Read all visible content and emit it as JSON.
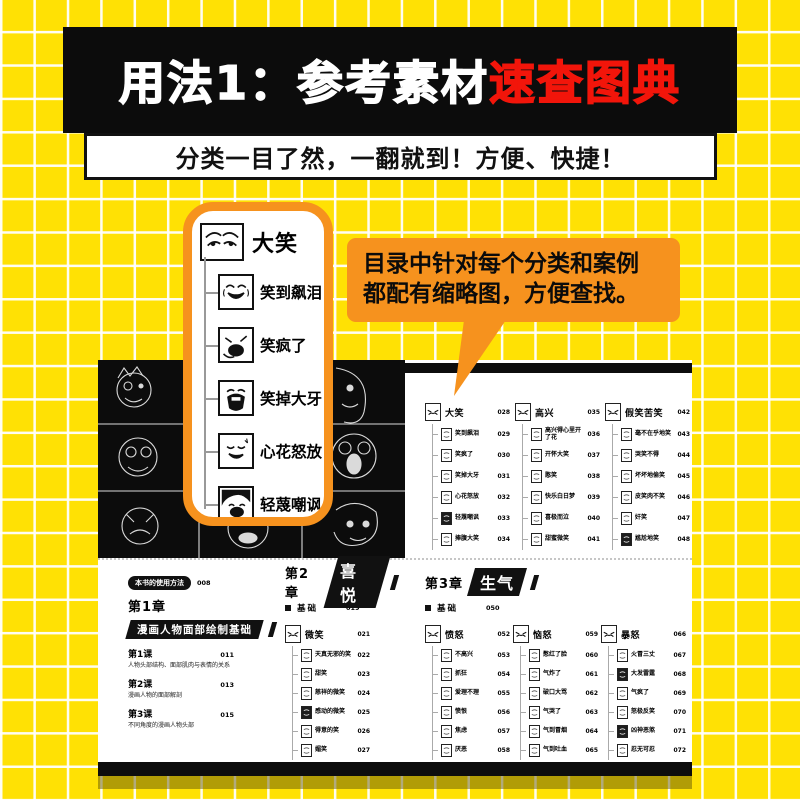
{
  "banner": {
    "title_white": "用法1：参考素材",
    "title_red": "速查图典"
  },
  "subtitle": {
    "text": "分类一目了然，一翻就到！方便、快捷！"
  },
  "bubble": {
    "line1": "目录中针对每个分类和案例",
    "line2": "都配有缩略图，方便查找。"
  },
  "callout": {
    "header_label": "大笑",
    "items": [
      {
        "label": "笑到飙泪",
        "icon": "laugh-tears-thumb"
      },
      {
        "label": "笑疯了",
        "icon": "laugh-crazy-thumb"
      },
      {
        "label": "笑掉大牙",
        "icon": "laugh-big-mouth-thumb"
      },
      {
        "label": "心花怒放",
        "icon": "laugh-bloom-thumb"
      },
      {
        "label": "轻蔑嘲讽",
        "icon": "sneer-face-thumb"
      }
    ]
  },
  "book": {
    "toc_top": {
      "columns": [
        {
          "title": "大笑",
          "page": "028",
          "items": [
            {
              "label": "笑到飙泪",
              "page": "029"
            },
            {
              "label": "笑疯了",
              "page": "030"
            },
            {
              "label": "笑掉大牙",
              "page": "031"
            },
            {
              "label": "心花怒放",
              "page": "032"
            },
            {
              "label": "轻蔑嘲讽",
              "page": "033",
              "dark": true
            },
            {
              "label": "捧腹大笑",
              "page": "034"
            }
          ]
        },
        {
          "title": "高兴",
          "page": "035",
          "items": [
            {
              "label": "高兴得心里开了花",
              "page": "036"
            },
            {
              "label": "开怀大笑",
              "page": "037"
            },
            {
              "label": "憨笑",
              "page": "038"
            },
            {
              "label": "快乐白日梦",
              "page": "039"
            },
            {
              "label": "喜极而泣",
              "page": "040"
            },
            {
              "label": "甜蜜微笑",
              "page": "041"
            }
          ]
        },
        {
          "title": "假笑苦笑",
          "page": "042",
          "items": [
            {
              "label": "毫不在乎地笑",
              "page": "043"
            },
            {
              "label": "哭笑不得",
              "page": "044"
            },
            {
              "label": "坏坏地偷笑",
              "page": "045"
            },
            {
              "label": "皮笑肉不笑",
              "page": "046"
            },
            {
              "label": "奸笑",
              "page": "047"
            },
            {
              "label": "尴尬地笑",
              "page": "048",
              "dark": true
            }
          ]
        }
      ]
    },
    "toc_bottom": {
      "usage_badge": {
        "label": "本书的使用方法",
        "page": "008"
      },
      "chapter1": {
        "title": "第1章",
        "banner": "漫画人物面部绘制基础",
        "lessons": [
          {
            "label": "第1课",
            "page": "011",
            "desc": "人物头部结构、面部肌肉与表情的关系"
          },
          {
            "label": "第2课",
            "page": "013",
            "desc": "漫画人物的面部解剖"
          },
          {
            "label": "第3课",
            "page": "015",
            "desc": "不同角度的漫画人物头部"
          }
        ]
      },
      "chapter2": {
        "title": "第2章",
        "banner": "喜悦",
        "basic": {
          "label": "基础",
          "page": "019"
        },
        "group": {
          "title": "微笑",
          "page": "021",
          "items": [
            {
              "label": "天真无邪的笑",
              "page": "022"
            },
            {
              "label": "甜笑",
              "page": "023"
            },
            {
              "label": "慈祥的微笑",
              "page": "024"
            },
            {
              "label": "感动的微笑",
              "page": "025",
              "dark": true
            },
            {
              "label": "得意的笑",
              "page": "026"
            },
            {
              "label": "媚笑",
              "page": "027"
            }
          ]
        }
      },
      "chapter3": {
        "title": "第3章",
        "banner": "生气",
        "basic": {
          "label": "基础",
          "page": "050"
        },
        "groups": [
          {
            "title": "愤怒",
            "page": "052",
            "items": [
              {
                "label": "不高兴",
                "page": "053"
              },
              {
                "label": "抓狂",
                "page": "054"
              },
              {
                "label": "爱理不理",
                "page": "055"
              },
              {
                "label": "愤恨",
                "page": "056"
              },
              {
                "label": "焦虑",
                "page": "057"
              },
              {
                "label": "厌恶",
                "page": "058"
              }
            ]
          },
          {
            "title": "恼怒",
            "page": "059",
            "items": [
              {
                "label": "憋红了脸",
                "page": "060"
              },
              {
                "label": "气炸了",
                "page": "061"
              },
              {
                "label": "破口大骂",
                "page": "062"
              },
              {
                "label": "气哭了",
                "page": "063"
              },
              {
                "label": "气到冒烟",
                "page": "064"
              },
              {
                "label": "气到吐血",
                "page": "065"
              }
            ]
          },
          {
            "title": "暴怒",
            "page": "066",
            "items": [
              {
                "label": "火冒三丈",
                "page": "067"
              },
              {
                "label": "大发雷霆",
                "page": "068",
                "dark": true
              },
              {
                "label": "气疯了",
                "page": "069"
              },
              {
                "label": "怒极反笑",
                "page": "070"
              },
              {
                "label": "凶神恶煞",
                "page": "071",
                "dark": true
              },
              {
                "label": "忍无可忍",
                "page": "072"
              }
            ]
          }
        ]
      }
    }
  },
  "colors": {
    "yellow": "#ffe104",
    "orange": "#f6921e",
    "red": "#f2150a",
    "black": "#0c0c0c"
  }
}
